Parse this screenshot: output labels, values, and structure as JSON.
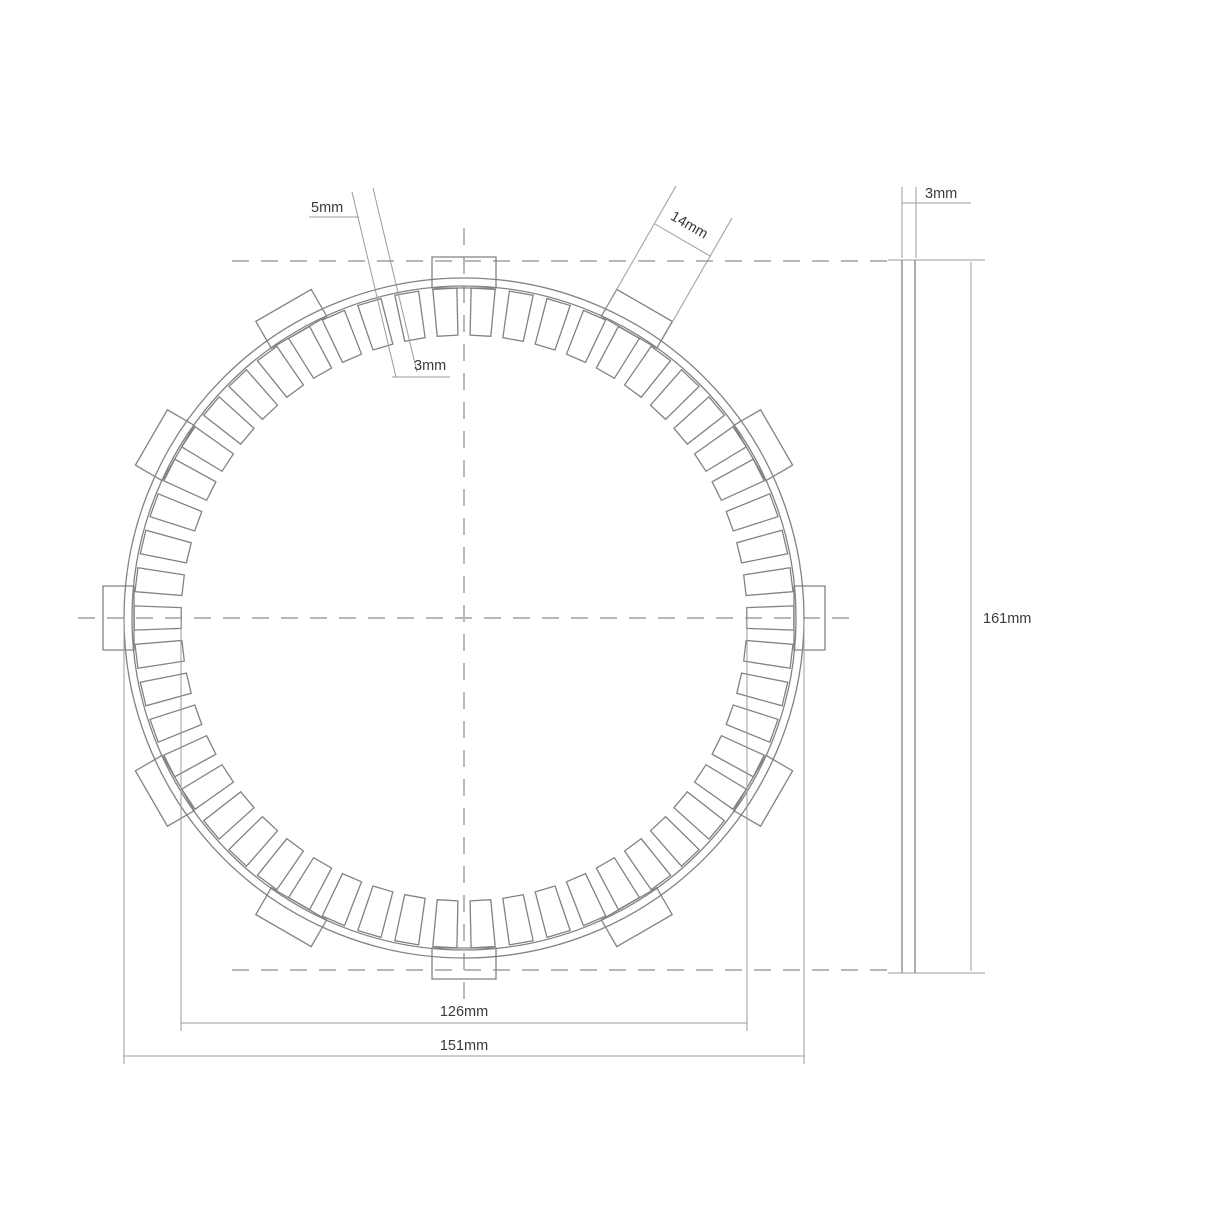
{
  "title": "Clutch friction plate technical drawing",
  "colors": {
    "background": "#ffffff",
    "line": "#828282",
    "dim_line": "#9b9b9b",
    "centerline": "#b8b8b8",
    "text": "#3a3a3a"
  },
  "labels": {
    "pad_slot_width": "5mm",
    "pad_gap": "3mm",
    "tab_width": "14mm",
    "thickness": "3mm",
    "overall_height": "161mm",
    "inner_diameter": "126mm",
    "outer_diameter": "151mm"
  },
  "front_view": {
    "cx": 464,
    "cy": 618,
    "rim_outer_r": 340,
    "rim_inner_r": 332,
    "pad_outer_r": 330,
    "pad_inner_r": 283,
    "pad_count": 54,
    "pad_half_angle_deg": 2.1,
    "gap_center_angle_deg": 90,
    "tab_count": 12,
    "tab_half_width": 32,
    "tab_inner_r": 330,
    "tab_outer_r": 361,
    "tab_start_angle_deg": 90,
    "tab_step_deg": 30
  },
  "side_view": {
    "plate_left": 902,
    "plate_right": 915,
    "top": 260,
    "bottom": 973
  }
}
